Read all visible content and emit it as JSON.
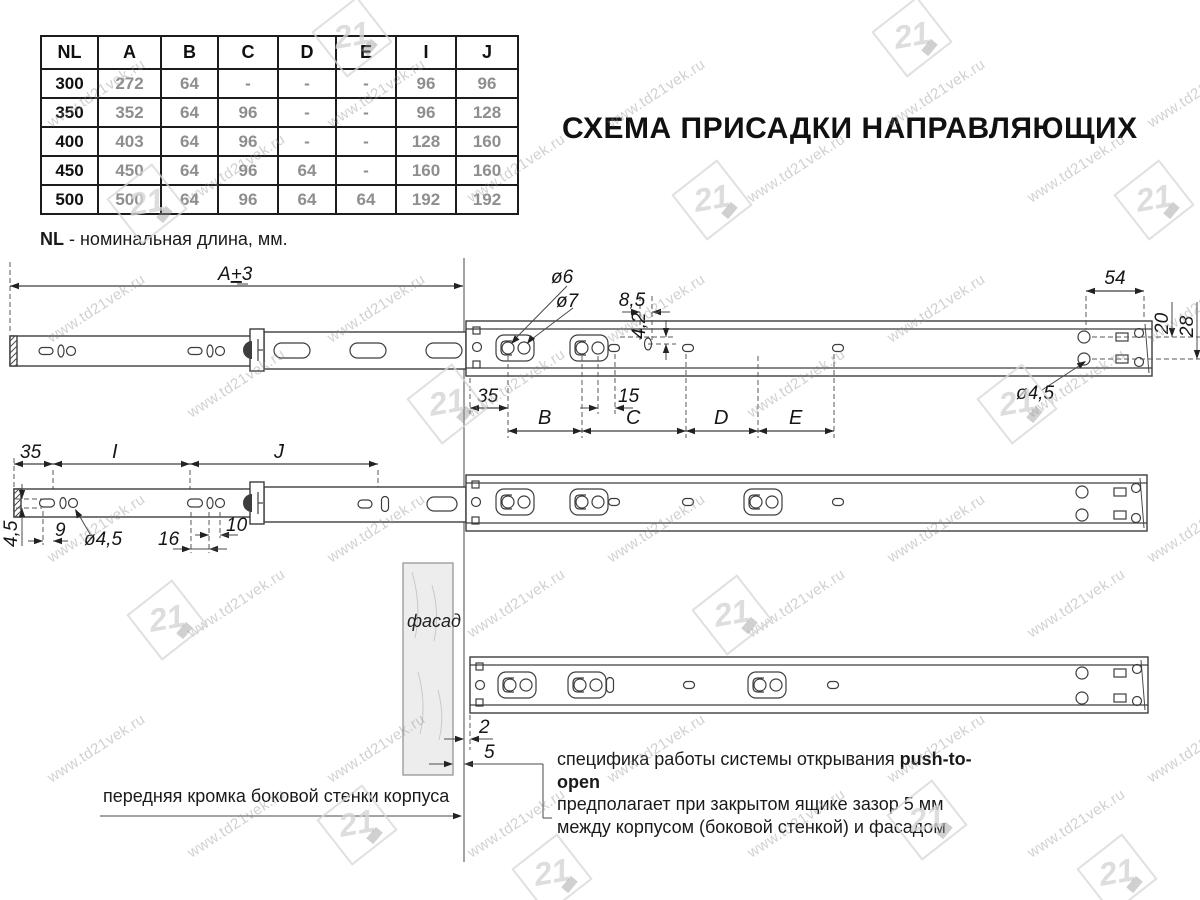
{
  "title": "СХЕМА ПРИСАДКИ НАПРАВЛЯЮЩИХ",
  "table": {
    "headers": [
      "NL",
      "A",
      "B",
      "C",
      "D",
      "E",
      "I",
      "J"
    ],
    "rows": [
      [
        "300",
        "272",
        "64",
        "-",
        "-",
        "-",
        "96",
        "96"
      ],
      [
        "350",
        "352",
        "64",
        "96",
        "-",
        "-",
        "96",
        "128"
      ],
      [
        "400",
        "403",
        "64",
        "96",
        "-",
        "-",
        "128",
        "160"
      ],
      [
        "450",
        "450",
        "64",
        "96",
        "64",
        "-",
        "160",
        "160"
      ],
      [
        "500",
        "500",
        "64",
        "96",
        "64",
        "64",
        "192",
        "192"
      ]
    ]
  },
  "legend": {
    "term": "NL",
    "text": " - номинальная длина, мм."
  },
  "dims": {
    "length_total": {
      "base": "A",
      "sign": "+",
      "tol": "3"
    },
    "dia6": "ø6",
    "dia7": "ø7",
    "off85": "8,5",
    "off42": "4,2",
    "front35": "35",
    "sp15": "15",
    "b": "B",
    "c": "C",
    "d": "D",
    "e": "E",
    "end54": "54",
    "row20": "20",
    "row28": "28",
    "dia45_top": "ø4,5",
    "back35": "35",
    "i": "I",
    "j": "J",
    "edge45": "4,5",
    "off9": "9",
    "dia45_mid": "ø4,5",
    "off16": "16",
    "off10": "10",
    "gap2": "2",
    "gap5": "5"
  },
  "labels": {
    "facade": "фасад",
    "front_edge": "передняя кромка боковой стенки корпуса"
  },
  "note": {
    "part1": "специфика работы системы открывания ",
    "bold": "push-to-open",
    "line2": "предполагает при закрытом ящике зазор 5 мм",
    "line3": "между корпусом (боковой стенкой) и фасадом"
  },
  "watermark": {
    "url": "www.td21vek.ru",
    "logo": "21"
  }
}
